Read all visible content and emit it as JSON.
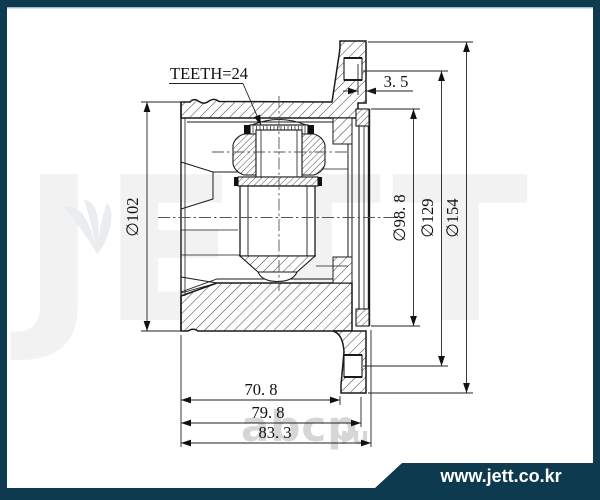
{
  "frame": {
    "border_color": "#0d3a4e",
    "background": "#ffffff",
    "inner_top_line_color": "#9fbdc7"
  },
  "banner": {
    "text": "www.jett.co.kr",
    "bg": "#0d3a4e",
    "fg": "#ffffff"
  },
  "watermark": {
    "brand": "JETT",
    "brand_color": "#f2f2f2",
    "logo_color": "#e9edf0",
    "shop_name": "abcp",
    "shop_tld": ".ru",
    "shop_color": "#d6d6d6"
  },
  "drawing": {
    "type": "technical-cross-section",
    "ink_color": "#1a1a1a",
    "centerline_color": "#555555",
    "labels": {
      "teeth": "TEETH=24",
      "plate_thickness": "3. 5",
      "outer_diameter": "∅102",
      "cover_diameter": "∅98. 8",
      "bolt_circle_diameter": "∅129",
      "flange_diameter": "∅154",
      "housing_length": "70. 8",
      "length_to_flange": "79. 8",
      "total_length": "83. 3"
    }
  }
}
